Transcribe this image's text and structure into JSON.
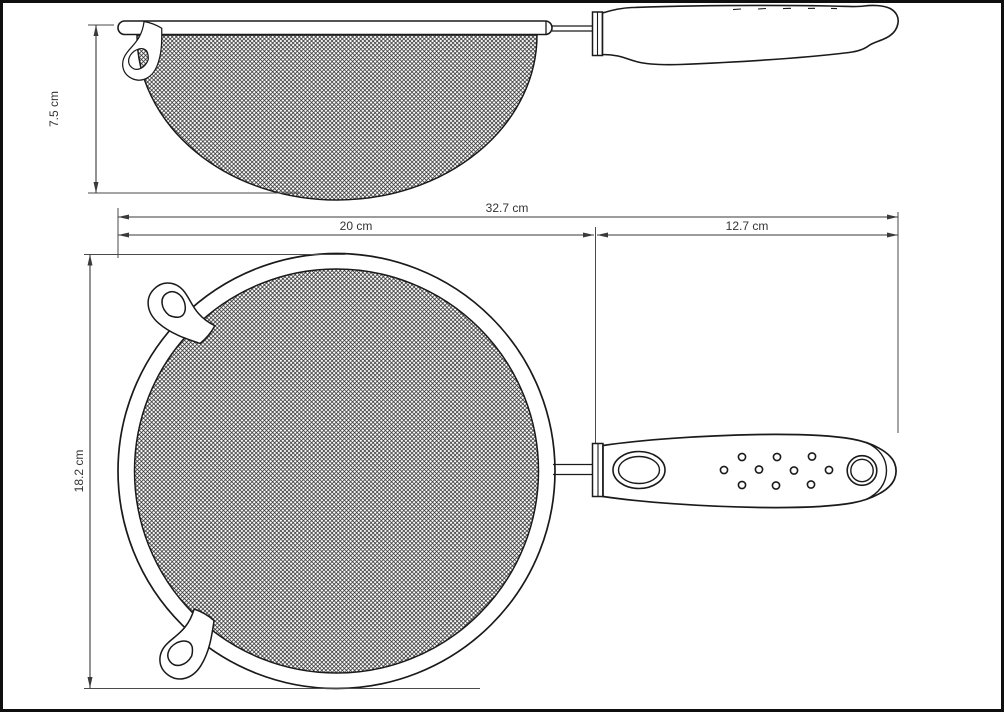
{
  "diagram": {
    "subject": "strainer technical drawing",
    "dimensions": {
      "side_height": "7.5 cm",
      "total_length": "32.7 cm",
      "bowl_section": "20 cm",
      "handle_section": "12.7 cm",
      "top_height": "18.2 cm"
    },
    "colors": {
      "background": "#ffffff",
      "outline": "#1a1a1a",
      "dimension_line": "#3a3a3a",
      "mesh_line": "#2f2f2f",
      "border": "#0f0f0f"
    }
  }
}
